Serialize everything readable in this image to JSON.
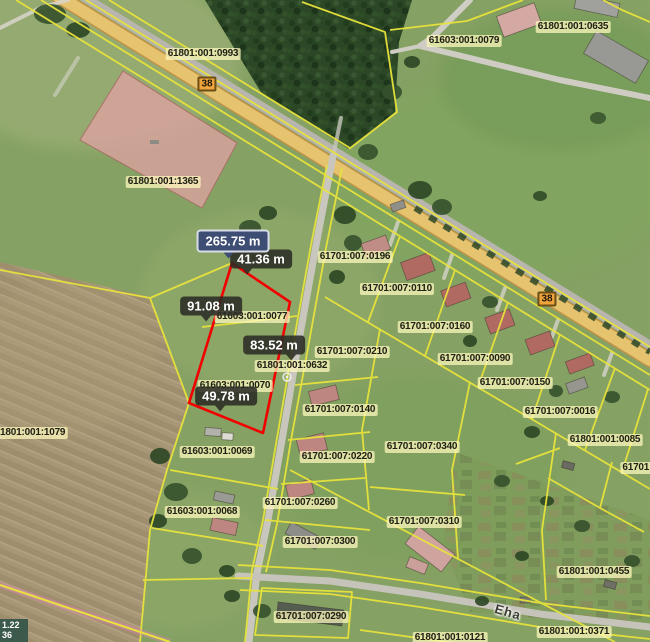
{
  "app": {
    "type": "cadastral-map-viewer"
  },
  "map": {
    "parcel_labels": [
      {
        "id": "61801:001:0993",
        "x": 203,
        "y": 54
      },
      {
        "id": "61603:001:0079",
        "x": 464,
        "y": 41
      },
      {
        "id": "61801:001:0635",
        "x": 573,
        "y": 27
      },
      {
        "id": "61801:001:1365",
        "x": 163,
        "y": 182
      },
      {
        "id": "61701:007:0196",
        "x": 355,
        "y": 257
      },
      {
        "id": "61701:007:0110",
        "x": 397,
        "y": 289
      },
      {
        "id": "61603:001:0077",
        "x": 252,
        "y": 317
      },
      {
        "id": "61701:007:0160",
        "x": 435,
        "y": 327
      },
      {
        "id": "61701:007:0210",
        "x": 352,
        "y": 352
      },
      {
        "id": "61701:007:0090",
        "x": 475,
        "y": 359
      },
      {
        "id": "61801:001:0632",
        "x": 292,
        "y": 366
      },
      {
        "id": "61701:007:0150",
        "x": 515,
        "y": 383
      },
      {
        "id": "61603:001:0070",
        "x": 235,
        "y": 386
      },
      {
        "id": "61701:007:0140",
        "x": 340,
        "y": 410
      },
      {
        "id": "61701:007:0016",
        "x": 560,
        "y": 412
      },
      {
        "id": "61801:001:1079",
        "x": 30,
        "y": 433
      },
      {
        "id": "61801:001:0085",
        "x": 605,
        "y": 440
      },
      {
        "id": "61701:007:0340",
        "x": 422,
        "y": 447
      },
      {
        "id": "61603:001:0069",
        "x": 217,
        "y": 452
      },
      {
        "id": "61701:007:0220",
        "x": 337,
        "y": 457
      },
      {
        "id": "61701:0",
        "x": 640,
        "y": 468
      },
      {
        "id": "61701:007:0260",
        "x": 300,
        "y": 503
      },
      {
        "id": "61603:001:0068",
        "x": 202,
        "y": 512
      },
      {
        "id": "61701:007:0310",
        "x": 424,
        "y": 522
      },
      {
        "id": "61701:007:0300",
        "x": 320,
        "y": 542
      },
      {
        "id": "61801:001:0455",
        "x": 594,
        "y": 572
      },
      {
        "id": "61701:007:0290",
        "x": 311,
        "y": 617
      },
      {
        "id": "61801:001:0371",
        "x": 574,
        "y": 632
      },
      {
        "id": "61801:001:0121",
        "x": 450,
        "y": 638
      }
    ],
    "road_badges": [
      {
        "number": "38",
        "x": 207,
        "y": 84
      },
      {
        "number": "38",
        "x": 547,
        "y": 299
      }
    ],
    "street_label": {
      "text": "Eha",
      "x": 508,
      "y": 612,
      "rotation_deg": 16
    },
    "coordinate_readout": {
      "line1": "1.22",
      "line2": "36"
    },
    "measurement": {
      "total": {
        "value": "265.75 m",
        "x": 233,
        "y": 241,
        "tail_x_pct": 44
      },
      "segments": [
        {
          "value": "41.36 m",
          "x": 261,
          "y": 259,
          "tail_x_pct": 28
        },
        {
          "value": "91.08 m",
          "x": 211,
          "y": 306,
          "tail_x_pct": 42
        },
        {
          "value": "83.52 m",
          "x": 274,
          "y": 345,
          "tail_x_pct": 78
        },
        {
          "value": "49.78 m",
          "x": 226,
          "y": 396,
          "tail_x_pct": 40
        }
      ]
    },
    "colors": {
      "parcel_line": "#e8e33c",
      "measure_line": "#f20000",
      "total_tooltip_bg": "#3e4d74",
      "segment_tooltip_bg": "rgba(43,43,37,0.87)",
      "label_chip_bg": "rgba(253,248,189,0.74)",
      "road_badge_bg": "#f0a43c",
      "highlight_parcel_fill": "rgba(219,163,160,0.8)"
    }
  }
}
